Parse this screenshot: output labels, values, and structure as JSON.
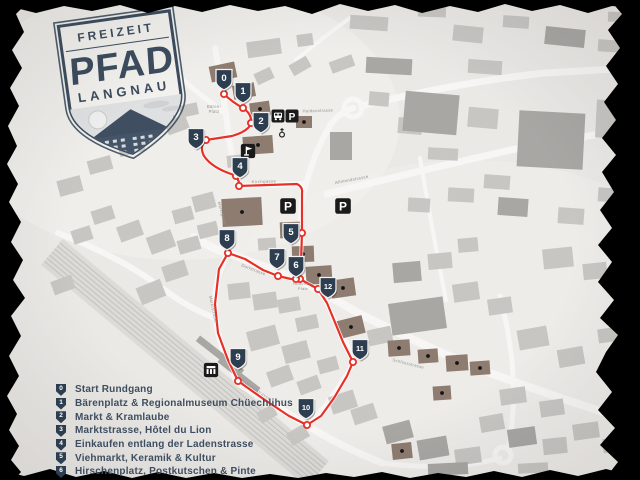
{
  "logo": {
    "freizeit": "FREIZEIT",
    "pfad": "PFAD",
    "langnau": "LANGNAU"
  },
  "legend": {
    "items": [
      {
        "num": "0",
        "label": "Start Rundgang"
      },
      {
        "num": "1",
        "label": "Bärenplatz & Regionalmuseum Chüechlihus"
      },
      {
        "num": "2",
        "label": "Markt & Kramlaube"
      },
      {
        "num": "3",
        "label": "Marktstrasse, Hôtel du Lion"
      },
      {
        "num": "4",
        "label": "Einkaufen entlang der Ladenstrasse"
      },
      {
        "num": "5",
        "label": "Viehmarkt, Keramik & Kultur"
      },
      {
        "num": "6",
        "label": "Hirschenplatz, Postkutschen & Pinte"
      }
    ]
  },
  "colors": {
    "paper": "#ebe9e6",
    "road": "#f7f6f4",
    "railway": "#c3c2bf",
    "route_red": "#e63028",
    "marker_navy": "#2d3e51",
    "building_gray": "#c7c6c3",
    "building_dark": "#a8a7a4",
    "building_brown": "#8e7c71",
    "street_label": "#97958f",
    "icon_black": "#1a1a1a",
    "logo_navy": "#3c4c5e"
  },
  "map": {
    "markers": [
      {
        "num": "0",
        "x": 224,
        "y": 79
      },
      {
        "num": "1",
        "x": 243,
        "y": 92
      },
      {
        "num": "2",
        "x": 261,
        "y": 122
      },
      {
        "num": "3",
        "x": 196,
        "y": 138
      },
      {
        "num": "4",
        "x": 240,
        "y": 167
      },
      {
        "num": "5",
        "x": 291,
        "y": 233
      },
      {
        "num": "6",
        "x": 296,
        "y": 266
      },
      {
        "num": "7",
        "x": 277,
        "y": 258
      },
      {
        "num": "8",
        "x": 227,
        "y": 239
      },
      {
        "num": "9",
        "x": 238,
        "y": 358
      },
      {
        "num": "10",
        "x": 306,
        "y": 408
      },
      {
        "num": "11",
        "x": 360,
        "y": 349
      },
      {
        "num": "12",
        "x": 328,
        "y": 287
      }
    ],
    "map_icons": [
      {
        "type": "bus",
        "x": 278,
        "y": 116,
        "s": 1
      },
      {
        "type": "parking",
        "x": 292,
        "y": 116,
        "s": 1
      },
      {
        "type": "parking",
        "x": 288,
        "y": 206,
        "s": 1.2
      },
      {
        "type": "parking",
        "x": 343,
        "y": 206,
        "s": 1.2
      },
      {
        "type": "church",
        "x": 282,
        "y": 133,
        "s": 1
      },
      {
        "type": "museum",
        "x": 248,
        "y": 151,
        "s": 1.1
      },
      {
        "type": "station",
        "x": 211,
        "y": 370,
        "s": 1.1
      }
    ],
    "streets": [
      {
        "t": "Bären-",
        "x": 214,
        "y": 108,
        "r": 0,
        "s": 4.2
      },
      {
        "t": "Platz",
        "x": 214,
        "y": 113,
        "r": 0,
        "s": 4.2
      },
      {
        "t": "Kirchgasse",
        "x": 264,
        "y": 183,
        "r": -2,
        "s": 4.4
      },
      {
        "t": "Haldenstrasse",
        "x": 318,
        "y": 112,
        "r": -2,
        "s": 4.2
      },
      {
        "t": "Allmendstrasse",
        "x": 352,
        "y": 181,
        "r": -11,
        "s": 4.4
      },
      {
        "t": "Marktgasse",
        "x": 221,
        "y": 214,
        "r": 74,
        "s": 4.2
      },
      {
        "t": "Dorfstrasse",
        "x": 253,
        "y": 271,
        "r": 21,
        "s": 4.4
      },
      {
        "t": "Hirschen-",
        "x": 303,
        "y": 285,
        "r": 0,
        "s": 4.0
      },
      {
        "t": "Platz",
        "x": 303,
        "y": 290,
        "r": 0,
        "s": 4.0
      },
      {
        "t": "Marktstrasse",
        "x": 212,
        "y": 310,
        "r": 78,
        "s": 4.4
      },
      {
        "t": "Bahnhofstrasse",
        "x": 255,
        "y": 391,
        "r": 33,
        "s": 4.4
      },
      {
        "t": "Schlossstrasse",
        "x": 408,
        "y": 365,
        "r": 14,
        "s": 4.2
      }
    ],
    "route": {
      "path": "M224,86 L224,94 Q232,102 243,108 Q252,114 251,123 Q249,131 232,136 L206,140 Q199,146 204,156 Q212,168 234,175 Q240,180 239,186 L297,184 Q303,187 302,193 L302,233 L301,262 L300,279 L307,283 L318,289 L327,303 L334,320 L343,342 L353,362 L347,376 L334,398 L321,416 L307,425 L289,416 L262,398 L238,381 L228,360 L218,333 L215,304 L219,269 L228,253 L245,259 L263,270 L278,276 L291,279 L300,279",
      "stops": [
        [
          224,
          94
        ],
        [
          243,
          108
        ],
        [
          251,
          123
        ],
        [
          206,
          140
        ],
        [
          236,
          176
        ],
        [
          239,
          186
        ],
        [
          302,
          233
        ],
        [
          300,
          279
        ],
        [
          318,
          289
        ],
        [
          353,
          362
        ],
        [
          307,
          425
        ],
        [
          238,
          381
        ],
        [
          228,
          253
        ],
        [
          278,
          276
        ],
        [
          296,
          279
        ]
      ]
    },
    "roads": [
      {
        "d": "M215,48 Q222,88 226,114 Q230,152 238,186",
        "w": 6
      },
      {
        "d": "M158,58 Q198,94 226,114",
        "w": 5
      },
      {
        "d": "M238,186 L306,184",
        "w": 6
      },
      {
        "d": "M306,184 Q298,210 302,236 Q300,262 302,281",
        "w": 6
      },
      {
        "d": "M306,184 Q316,148 331,124 Q340,112 353,108",
        "w": 6
      },
      {
        "d": "M362,106 Q460,82 545,73 L634,68",
        "w": 7
      },
      {
        "d": "M327,194 Q430,168 520,148 L634,128",
        "w": 7
      },
      {
        "d": "M194,237 Q214,250 228,253 L302,281 Q332,298 362,315 Q422,345 482,370 Q552,396 634,422",
        "w": 8
      },
      {
        "d": "M228,253 Q214,280 215,306 Q216,340 230,366 Q234,375 238,383",
        "w": 6
      },
      {
        "d": "M238,383 Q272,403 308,426 Q342,447 382,463",
        "w": 7
      },
      {
        "d": "M308,426 Q332,400 354,362 Q346,338 334,319 Q326,300 318,288",
        "w": 5
      },
      {
        "d": "M58,233 Q122,258 162,288 Q188,308 215,318",
        "w": 6
      },
      {
        "d": "M296,60 Q322,38 350,18",
        "w": 4
      },
      {
        "d": "M382,463 Q452,472 500,458",
        "w": 5
      },
      {
        "d": "M500,296 Q522,380 508,450",
        "w": 5
      },
      {
        "d": "M420,158 Q432,230 446,300",
        "w": 4
      }
    ],
    "roundabouts": [
      [
        353,
        108,
        9
      ],
      [
        503,
        455,
        8
      ]
    ],
    "railway": {
      "x1": 52,
      "y1": 252,
      "x2": 318,
      "y2": 474,
      "tracks": 7,
      "gap": 4
    },
    "buildings": [
      [
        247,
        40,
        34,
        16,
        -8,
        "g"
      ],
      [
        297,
        34,
        16,
        12,
        -8,
        "g"
      ],
      [
        350,
        16,
        38,
        14,
        4,
        "g"
      ],
      [
        418,
        5,
        28,
        12,
        2,
        "g"
      ],
      [
        453,
        26,
        30,
        16,
        6,
        "g"
      ],
      [
        503,
        16,
        26,
        12,
        4,
        "g"
      ],
      [
        545,
        28,
        40,
        18,
        6,
        "d"
      ],
      [
        598,
        40,
        24,
        12,
        4,
        "g"
      ],
      [
        366,
        58,
        46,
        16,
        3,
        "d"
      ],
      [
        468,
        60,
        34,
        14,
        4,
        "g"
      ],
      [
        608,
        12,
        20,
        10,
        2,
        "g"
      ],
      [
        330,
        58,
        24,
        12,
        -20,
        "g"
      ],
      [
        290,
        60,
        20,
        12,
        -30,
        "g"
      ],
      [
        255,
        70,
        18,
        12,
        -25,
        "g"
      ],
      [
        96,
        90,
        30,
        22,
        -12,
        "b"
      ],
      [
        138,
        106,
        24,
        16,
        -10,
        "g"
      ],
      [
        210,
        64,
        26,
        16,
        -12,
        "b"
      ],
      [
        233,
        84,
        22,
        14,
        -10,
        "b"
      ],
      [
        250,
        102,
        20,
        14,
        -8,
        "b"
      ],
      [
        180,
        104,
        18,
        12,
        -12,
        "g"
      ],
      [
        166,
        118,
        22,
        14,
        -20,
        "g"
      ],
      [
        118,
        138,
        26,
        16,
        -15,
        "g"
      ],
      [
        88,
        158,
        24,
        14,
        -15,
        "g"
      ],
      [
        296,
        116,
        16,
        12,
        0,
        "b"
      ],
      [
        243,
        136,
        30,
        18,
        -4,
        "b"
      ],
      [
        227,
        155,
        18,
        12,
        -6,
        "g"
      ],
      [
        330,
        132,
        22,
        28,
        0,
        "d"
      ],
      [
        369,
        92,
        20,
        14,
        5,
        "g"
      ],
      [
        398,
        118,
        24,
        16,
        5,
        "g"
      ],
      [
        404,
        93,
        54,
        40,
        5,
        "d"
      ],
      [
        468,
        108,
        30,
        20,
        5,
        "g"
      ],
      [
        518,
        112,
        66,
        56,
        3,
        "d"
      ],
      [
        596,
        100,
        22,
        38,
        3,
        "g"
      ],
      [
        428,
        148,
        30,
        12,
        3,
        "g"
      ],
      [
        484,
        175,
        26,
        14,
        4,
        "g"
      ],
      [
        193,
        194,
        22,
        16,
        -15,
        "g"
      ],
      [
        173,
        208,
        20,
        14,
        -15,
        "g"
      ],
      [
        222,
        198,
        40,
        28,
        -3,
        "b"
      ],
      [
        280,
        222,
        20,
        16,
        -2,
        "b"
      ],
      [
        292,
        246,
        22,
        16,
        -2,
        "b"
      ],
      [
        306,
        266,
        26,
        18,
        -4,
        "b"
      ],
      [
        331,
        279,
        24,
        18,
        -8,
        "b"
      ],
      [
        258,
        238,
        18,
        12,
        -4,
        "g"
      ],
      [
        198,
        223,
        20,
        14,
        -14,
        "g"
      ],
      [
        178,
        238,
        22,
        14,
        -16,
        "g"
      ],
      [
        148,
        233,
        26,
        18,
        -20,
        "g"
      ],
      [
        118,
        223,
        24,
        16,
        -20,
        "g"
      ],
      [
        92,
        208,
        22,
        14,
        -18,
        "g"
      ],
      [
        163,
        263,
        24,
        16,
        -18,
        "g"
      ],
      [
        138,
        283,
        26,
        18,
        -22,
        "g"
      ],
      [
        228,
        283,
        22,
        16,
        -6,
        "g"
      ],
      [
        253,
        293,
        24,
        16,
        -8,
        "g"
      ],
      [
        278,
        298,
        22,
        14,
        -10,
        "g"
      ],
      [
        296,
        316,
        22,
        14,
        -12,
        "g"
      ],
      [
        338,
        318,
        26,
        18,
        -14,
        "b"
      ],
      [
        368,
        328,
        24,
        16,
        -12,
        "g"
      ],
      [
        393,
        262,
        28,
        20,
        -5,
        "d"
      ],
      [
        428,
        253,
        24,
        16,
        -5,
        "g"
      ],
      [
        458,
        238,
        20,
        14,
        -5,
        "g"
      ],
      [
        453,
        283,
        26,
        18,
        -8,
        "g"
      ],
      [
        488,
        298,
        24,
        16,
        -8,
        "g"
      ],
      [
        408,
        198,
        22,
        14,
        3,
        "g"
      ],
      [
        448,
        188,
        26,
        14,
        3,
        "g"
      ],
      [
        498,
        198,
        30,
        18,
        4,
        "d"
      ],
      [
        558,
        208,
        26,
        16,
        4,
        "g"
      ],
      [
        598,
        188,
        22,
        14,
        4,
        "g"
      ],
      [
        543,
        248,
        30,
        20,
        -6,
        "g"
      ],
      [
        583,
        263,
        24,
        16,
        -6,
        "g"
      ],
      [
        613,
        238,
        18,
        12,
        -6,
        "g"
      ],
      [
        390,
        300,
        55,
        32,
        -8,
        "d"
      ],
      [
        388,
        340,
        22,
        16,
        -4,
        "b"
      ],
      [
        418,
        349,
        20,
        14,
        -4,
        "b"
      ],
      [
        446,
        355,
        22,
        16,
        -4,
        "b"
      ],
      [
        470,
        361,
        20,
        14,
        -4,
        "b"
      ],
      [
        433,
        386,
        18,
        14,
        -4,
        "b"
      ],
      [
        518,
        328,
        30,
        20,
        -10,
        "g"
      ],
      [
        558,
        348,
        26,
        18,
        -10,
        "g"
      ],
      [
        598,
        328,
        22,
        14,
        -8,
        "g"
      ],
      [
        606,
        368,
        24,
        16,
        -12,
        "g"
      ],
      [
        500,
        388,
        26,
        16,
        -8,
        "g"
      ],
      [
        540,
        400,
        24,
        16,
        -8,
        "g"
      ],
      [
        480,
        415,
        24,
        16,
        -10,
        "g"
      ],
      [
        508,
        428,
        28,
        18,
        -8,
        "d"
      ],
      [
        543,
        438,
        24,
        16,
        -6,
        "g"
      ],
      [
        573,
        423,
        26,
        16,
        -8,
        "g"
      ],
      [
        603,
        438,
        22,
        14,
        -6,
        "g"
      ],
      [
        418,
        438,
        30,
        20,
        -10,
        "d"
      ],
      [
        455,
        448,
        26,
        16,
        -8,
        "g"
      ],
      [
        392,
        443,
        20,
        16,
        -6,
        "b"
      ],
      [
        428,
        463,
        40,
        12,
        -3,
        "d"
      ],
      [
        518,
        463,
        30,
        10,
        -3,
        "g"
      ],
      [
        352,
        406,
        24,
        16,
        -18,
        "g"
      ],
      [
        330,
        393,
        26,
        18,
        -18,
        "g"
      ],
      [
        384,
        423,
        28,
        18,
        -15,
        "d"
      ],
      [
        248,
        328,
        30,
        20,
        -15,
        "g"
      ],
      [
        283,
        343,
        26,
        18,
        -15,
        "g"
      ],
      [
        268,
        368,
        24,
        16,
        -20,
        "g"
      ],
      [
        298,
        378,
        22,
        14,
        -20,
        "g"
      ],
      [
        318,
        358,
        20,
        14,
        -15,
        "g"
      ],
      [
        258,
        408,
        18,
        12,
        -30,
        "g"
      ],
      [
        288,
        428,
        20,
        14,
        -30,
        "g"
      ],
      [
        192,
        352,
        56,
        7,
        38,
        "d"
      ],
      [
        214,
        372,
        50,
        6,
        38,
        "d"
      ],
      [
        58,
        178,
        24,
        16,
        -15,
        "g"
      ],
      [
        72,
        228,
        20,
        14,
        -18,
        "g"
      ],
      [
        52,
        278,
        22,
        14,
        -20,
        "g"
      ]
    ]
  }
}
